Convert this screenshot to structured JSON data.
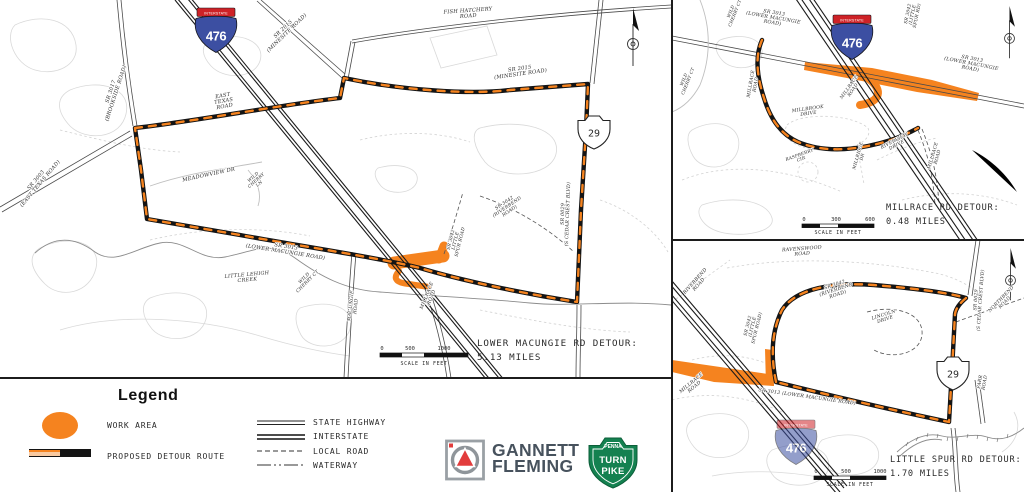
{
  "colors": {
    "work_area_orange": "#F5831F",
    "detour_black": "#141414",
    "interstate_shield_blue": "#3C4FA2",
    "interstate_shield_red": "#CE2227",
    "turnpike_green": "#148150",
    "gannett_text_color": "#47525D",
    "gannett_red": "#E23C3C"
  },
  "legend": {
    "title": "Legend",
    "work_area_label": "WORK AREA",
    "detour_label": "PROPOSED DETOUR ROUTE",
    "line_types": [
      "STATE HIGHWAY",
      "INTERSTATE",
      "LOCAL ROAD",
      "WATERWAY"
    ]
  },
  "logos": {
    "gannett_line1": "GANNETT",
    "gannett_line2": "FLEMING",
    "turnpike_top": "PENNA",
    "turnpike_mid": "TURN",
    "turnpike_bottom": "PIKE"
  },
  "panels": {
    "lower_macungie": {
      "title_line1": "LOWER MACUNGIE RD DETOUR:",
      "title_line2": "5.13 MILES",
      "scale": {
        "t0": "0",
        "t1": "500",
        "t2": "1000",
        "caption": "SCALE IN FEET"
      },
      "interstate_banner": "INTERSTATE",
      "interstate_number": "476",
      "state_route": "29",
      "labels": [
        {
          "t": "SR 3017\n(BROOKSIDE ROAD)",
          "x": 112,
          "y": 92,
          "r": -72,
          "s": 5.2
        },
        {
          "t": "SR 2015\n(MINESITE ROAD)",
          "x": 284,
          "y": 30,
          "r": -44,
          "s": 5.2
        },
        {
          "t": "FISH HATCHERY\nROAD",
          "x": 468,
          "y": 12,
          "r": -4,
          "s": 5.2
        },
        {
          "t": "SR 2015\n(MINESITE ROAD)",
          "x": 520,
          "y": 70,
          "r": -8,
          "s": 5.2
        },
        {
          "t": "EAST\nTEXAS\nROAD",
          "x": 223,
          "y": 97,
          "r": -10,
          "s": 5.2
        },
        {
          "t": "SR 3003\n(EAST TEXAS ROAD)",
          "x": 37,
          "y": 181,
          "r": -50,
          "s": 5.2
        },
        {
          "t": "MEADOWVIEW DR",
          "x": 209,
          "y": 176,
          "r": -12,
          "s": 5.2
        },
        {
          "t": "WILD\nCHERRY\nLN",
          "x": 254,
          "y": 178,
          "r": -42,
          "s": 4.3
        },
        {
          "t": "SR 3013\n(LOWER MACUNGIE ROAD)",
          "x": 286,
          "y": 248,
          "r": 9,
          "s": 5.2
        },
        {
          "t": "WILD\nCHERRY CT",
          "x": 305,
          "y": 279,
          "r": -45,
          "s": 4.5
        },
        {
          "t": "LITTLE LEHIGH\nCREEK",
          "x": 247,
          "y": 276,
          "r": -5,
          "s": 5
        },
        {
          "t": "MACUNGIE\nROAD",
          "x": 352,
          "y": 306,
          "r": -84,
          "s": 4.8
        },
        {
          "t": "MILLRACE\nROAD",
          "x": 428,
          "y": 296,
          "r": -68,
          "s": 4.8
        },
        {
          "t": "SR 3042\nLITTLE\nSPUR ROAD",
          "x": 452,
          "y": 240,
          "r": -76,
          "s": 4.5
        },
        {
          "t": "SR 3042\n(RIVERBEND\nROAD)",
          "x": 505,
          "y": 204,
          "r": -34,
          "s": 4.6
        },
        {
          "t": "SR 0029\n(S CEDAR CREST BLVD)",
          "x": 564,
          "y": 214,
          "r": -88,
          "s": 4.8
        }
      ]
    },
    "millrace": {
      "title_line1": "MILLRACE RD DETOUR:",
      "title_line2": "0.48 MILES",
      "scale": {
        "t0": "0",
        "t1": "300",
        "t2": "600",
        "caption": "SCALE IN FEET"
      },
      "interstate_banner": "INTERSTATE",
      "interstate_number": "476",
      "labels": [
        {
          "t": "WILD\nCHERRY CT",
          "x": 60,
          "y": 12,
          "r": -68,
          "s": 4.3
        },
        {
          "t": "WILD\nCHERRY CT",
          "x": 13,
          "y": 80,
          "r": -68,
          "s": 4.3
        },
        {
          "t": "SR 3013\n(LOWER MACUNGIE\nROAD)",
          "x": 102,
          "y": 14,
          "r": 10,
          "s": 4.8
        },
        {
          "t": "SR 3042\n(LITTLE\nSPUR RD)",
          "x": 237,
          "y": 14,
          "r": -78,
          "s": 4.5
        },
        {
          "t": "SR 3013\n(LOWER MACUNGIE\nROAD)",
          "x": 300,
          "y": 60,
          "r": 11,
          "s": 4.8
        },
        {
          "t": "MILLRACE\nROAD",
          "x": 80,
          "y": 84,
          "r": -80,
          "s": 4.6
        },
        {
          "t": "MILLRACE\nROAD",
          "x": 178,
          "y": 88,
          "r": -55,
          "s": 4.6
        },
        {
          "t": "MILLBROOK\nDRIVE",
          "x": 136,
          "y": 110,
          "r": -8,
          "s": 4.6
        },
        {
          "t": "RASPBERRY\nCIR",
          "x": 128,
          "y": 156,
          "r": -20,
          "s": 4.3
        },
        {
          "t": "MILLRIDGE\nDR",
          "x": 187,
          "y": 156,
          "r": -74,
          "s": 4.3
        },
        {
          "t": "RIVERVIEW\nDRIVE",
          "x": 223,
          "y": 142,
          "r": -28,
          "s": 4.6
        },
        {
          "t": "MILLRACE\nROAD",
          "x": 262,
          "y": 156,
          "r": -74,
          "s": 4.6
        }
      ]
    },
    "little_spur": {
      "title_line1": "LITTLE SPUR RD DETOUR:",
      "title_line2": "1.70 MILES",
      "scale": {
        "t0": "0",
        "t1": "500",
        "t2": "1000",
        "caption": "SCALE IN FEET"
      },
      "interstate_banner": "INTERSTATE",
      "interstate_number": "476",
      "state_route": "29",
      "labels": [
        {
          "t": "RAVENSWOOD\nROAD",
          "x": 130,
          "y": 10,
          "r": -4,
          "s": 4.8
        },
        {
          "t": "RIVERBEND\nROAD",
          "x": 24,
          "y": 42,
          "r": -48,
          "s": 4.8
        },
        {
          "t": "SR 3042\n(RIVERBEND\nROAD)",
          "x": 163,
          "y": 46,
          "r": -18,
          "s": 4.8
        },
        {
          "t": "LINCOLN\nDRIVE",
          "x": 212,
          "y": 76,
          "r": -18,
          "s": 4.6
        },
        {
          "t": "SR 0029\n(S CEDAR CREST BLVD)",
          "x": 305,
          "y": 60,
          "r": -86,
          "s": 4.6
        },
        {
          "t": "NORTHBEND\nROAD",
          "x": 330,
          "y": 60,
          "r": -46,
          "s": 4.6
        },
        {
          "t": "SR 3042\n(LITTLE\nSPUR ROAD)",
          "x": 77,
          "y": 86,
          "r": -76,
          "s": 4.5
        },
        {
          "t": "MILLRACE\nROAD",
          "x": 20,
          "y": 144,
          "r": -40,
          "s": 4.8
        },
        {
          "t": "SR 3013 (LOWER MACUNGIE ROAD)",
          "x": 135,
          "y": 158,
          "r": 8,
          "s": 4.8
        },
        {
          "t": "FARR\nROAD",
          "x": 309,
          "y": 142,
          "r": -80,
          "s": 4.6
        }
      ]
    }
  }
}
